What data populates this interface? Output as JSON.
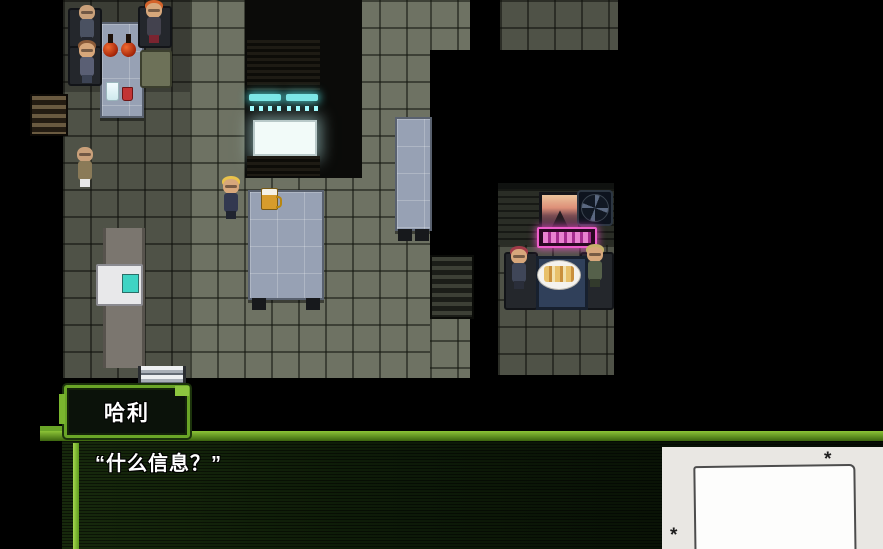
{
  "scene": {
    "description": "top-down rpg bar interior",
    "npcs": [
      {
        "id": "bald-patron-seated",
        "note": "bald man at drinks table"
      },
      {
        "id": "redhead-patron-seated",
        "note": "orange-haired patron at drinks table"
      },
      {
        "id": "brunette-patron-seated",
        "note": "brown-haired patron at drinks table"
      },
      {
        "id": "bald-man-standing",
        "note": "bald man standing on floor"
      },
      {
        "id": "blonde-player",
        "note": "blonde character beside bar counter"
      },
      {
        "id": "booth-redhead",
        "note": "red-haired patron in booth"
      },
      {
        "id": "booth-blonde",
        "note": "sandy-haired patron in booth"
      }
    ],
    "props": [
      "drinks-table",
      "liquor-bottles",
      "cocktail-glass",
      "red-drink",
      "bookshelf",
      "vending-machine",
      "stairs",
      "wall-screen",
      "ceiling-lights",
      "bar-counter",
      "beer-mug",
      "side-table",
      "shelf-pillar",
      "picture-frame",
      "wall-fan",
      "neon-sign",
      "booth-table",
      "food-plate"
    ]
  },
  "dialogue": {
    "speaker_name": "哈利",
    "message": "“什么信息？”"
  },
  "overlay": {
    "asterisk_top": "*",
    "asterisk_bottom": "*"
  },
  "colors": {
    "ui_green_bright": "#8dc63f",
    "ui_green_dark": "#3c660f",
    "dialogue_bg": "#0e1c08",
    "floor_tile": "#6e7263",
    "counter_blue": "#97a1b4",
    "neon_pink": "#ef5ecb",
    "screen_white": "#f2fbf9",
    "light_teal": "#7de6e6"
  }
}
